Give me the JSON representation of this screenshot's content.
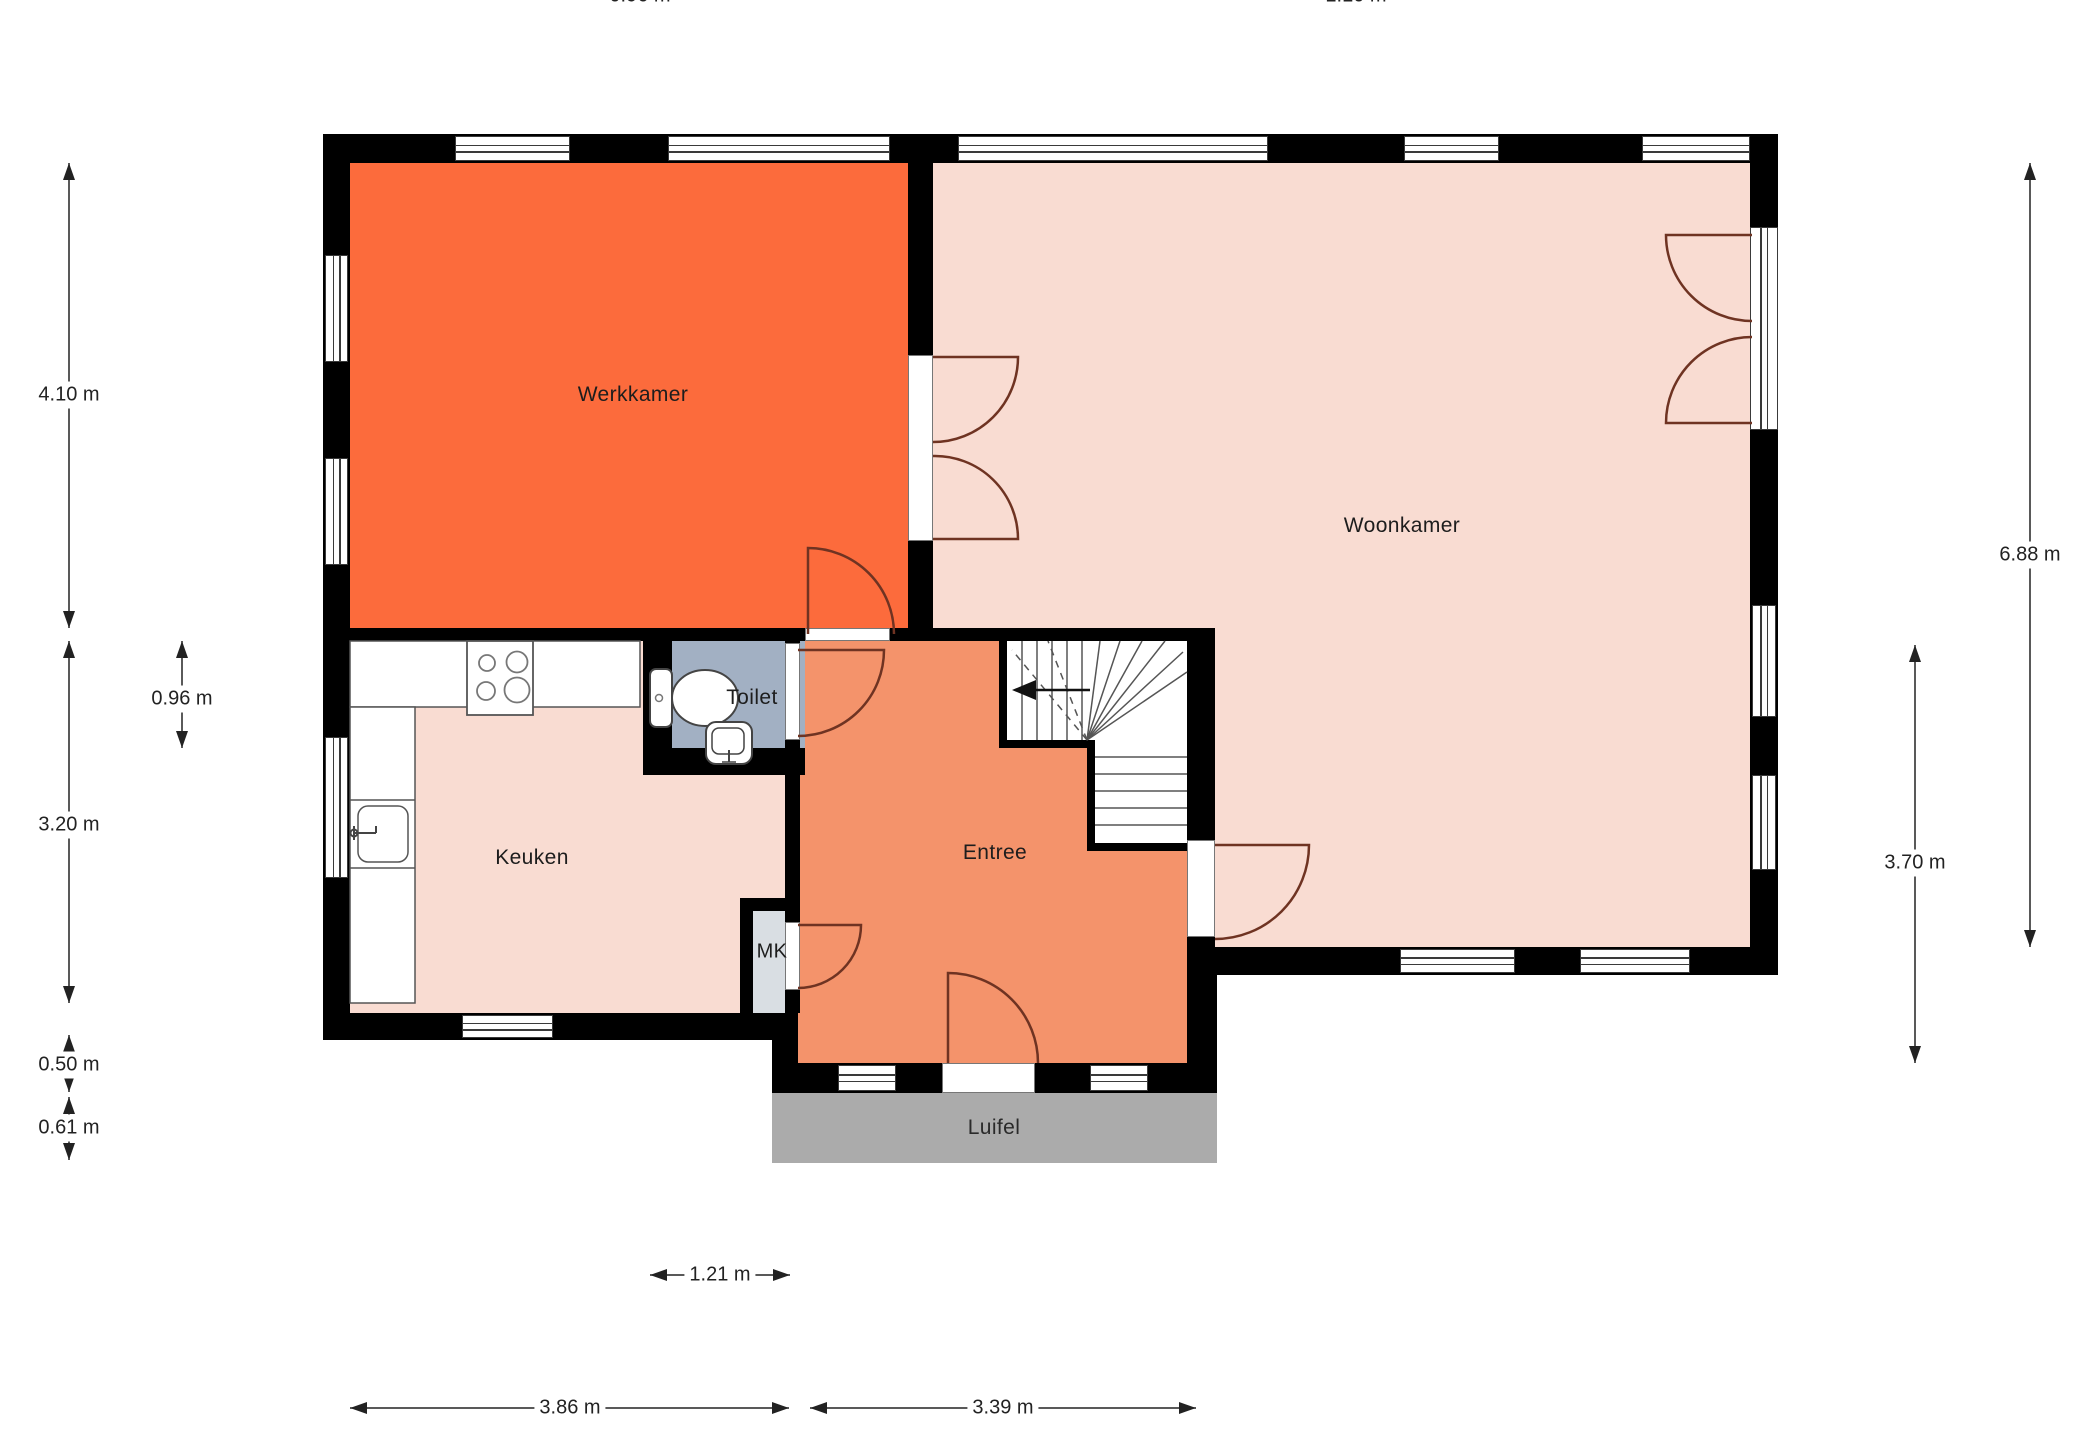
{
  "plan": {
    "rooms": {
      "werkkamer": {
        "label": "Werkkamer",
        "color": "#fc6b3c"
      },
      "woonkamer": {
        "label": "Woonkamer",
        "color": "#f9dcd2"
      },
      "keuken": {
        "label": "Keuken",
        "color": "#f9dcd2"
      },
      "toilet": {
        "label": "Toilet",
        "color": "#a2b0c3"
      },
      "entree": {
        "label": "Entree",
        "color": "#f4936b"
      },
      "mk": {
        "label": "MK",
        "color": "#d9dee3"
      },
      "luifel": {
        "label": "Luifel",
        "color": "#ababab"
      }
    },
    "dimensions": {
      "top": [
        {
          "label": "0.96 m"
        },
        {
          "label": "1.10 m"
        }
      ],
      "left": [
        {
          "label": "4.10 m"
        },
        {
          "label": "0.96 m"
        },
        {
          "label": "3.20 m"
        },
        {
          "label": "0.50 m"
        },
        {
          "label": "0.61 m"
        }
      ],
      "right": [
        {
          "label": "6.88 m"
        },
        {
          "label": "3.70 m"
        }
      ],
      "bottom": [
        {
          "label": "1.21 m"
        },
        {
          "label": "3.86 m"
        },
        {
          "label": "3.39 m"
        }
      ]
    },
    "colors": {
      "wall": "#000000",
      "door_arc": "#6f3322",
      "dimension": "#222222",
      "stair_lines": "#555555",
      "fixture_outline": "#444444"
    }
  }
}
